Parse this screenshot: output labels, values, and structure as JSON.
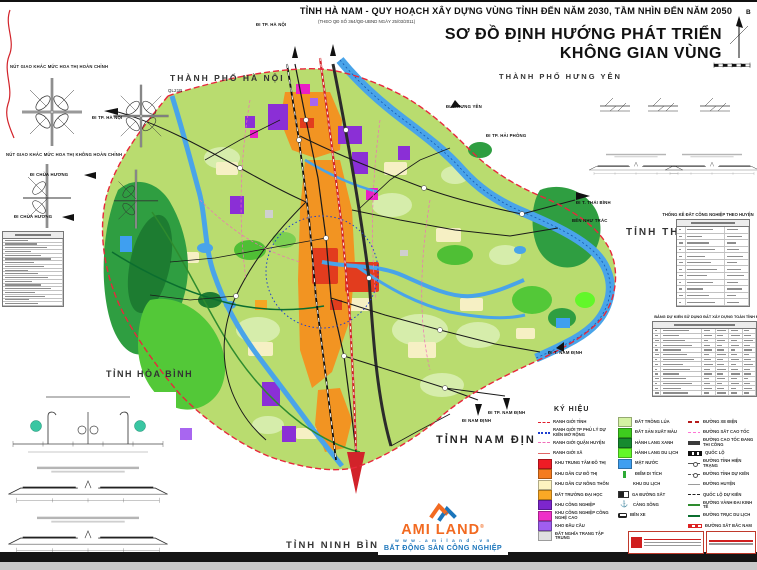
{
  "header": {
    "doc_title": "TỈNH HÀ NAM - QUY HOẠCH XÂY DỰNG VÙNG TỈNH ĐẾN NĂM 2030, TẦM NHÌN ĐẾN NĂM 2050",
    "doc_subtitle": "(THEO QĐ SỐ 364/QĐ-UBND NGÀY 25/03/2011)",
    "map_title_line1": "SƠ ĐỒ ĐỊNH HƯỚNG PHÁT TRIỂN",
    "map_title_line2": "KHÔNG GIAN VÙNG",
    "compass_label": "B"
  },
  "neighbors": {
    "ha_noi": "THÀNH PHỐ HÀ NỘI",
    "hung_yen": "THÀNH PHỐ HƯNG YÊN",
    "thai_binh": "TỈNH THÁI BÌNH",
    "hoa_binh": "TỈNH HÒA BÌNH",
    "nam_dinh": "TỈNH NAM ĐỊNH",
    "ninh_binh": "TỈNH NINH BÌNH"
  },
  "map_labels": {
    "di_tp_ha_noi_top": "ĐI TP. HÀ NỘI",
    "di_tp_ha_noi_left": "ĐI TP. HÀ NỘI",
    "ql21b": "QL21B",
    "di_t_hung_yen": "ĐI T. HƯNG YÊN",
    "di_tp_hai_phong": "ĐI TP. HẢI PHÒNG",
    "di_t_thai_binh": "ĐI T. THÁI BÌNH",
    "ben_nhu_trac": "BẾN NHƯ TRÁC",
    "di_t_nam_dinh": "ĐI T. NAM ĐỊNH",
    "di_nam_dinh": "ĐI NAM ĐỊNH",
    "di_tp_nam_dinh": "ĐI TP. NAM ĐỊNH",
    "di_chua_huong_1": "ĐI CHÙA HƯƠNG",
    "di_chua_huong_2": "ĐI CHÙA HƯƠNG"
  },
  "left_panel": {
    "interchange_title_full": "NÚT GIAO KHÁC MỨC HOA THỊ HOÀN CHỈNH",
    "interchange_title_partial": "NÚT GIAO KHÁC MỨC HOA THỊ KHÔNG HOÀN CHỈNH",
    "list_table": {
      "placeholder_rows": 18
    }
  },
  "right_panel": {
    "table_industry": {
      "title": "THỐNG KÊ ĐẤT CÔNG NGHIỆP THEO HUYỆN",
      "placeholder_rows": 12
    },
    "table_landuse": {
      "title": "BẢNG DỰ KIẾN SỬ DỤNG ĐẤT XÂY DỰNG TOÀN TỈNH ĐẾN NĂM 2030",
      "placeholder_rows": 14
    }
  },
  "legend": {
    "title": "KÝ HIỆU",
    "col1": [
      {
        "swatch": "line-red-dash",
        "label": "RANH GIỚI TỈNH"
      },
      {
        "swatch": "line-blue-dots",
        "label": "RANH GIỚI TP PHỦ LÝ DỰ KIẾN MỞ RỘNG"
      },
      {
        "swatch": "line-pink-dash",
        "label": "RANH GIỚI QUẬN HUYỆN"
      },
      {
        "swatch": "line-red-thin",
        "label": "RANH GIỚI XÃ"
      },
      {
        "color": "#ee1c25",
        "label": "KHU TRUNG TÂM ĐÔ THỊ"
      },
      {
        "color": "#f47b20",
        "label": "KHU DÂN CƯ ĐÔ THỊ"
      },
      {
        "color": "#fdf3c0",
        "label": "KHU DÂN CƯ NÔNG THÔN"
      },
      {
        "color": "#f9a825",
        "label": "ĐẤT TRƯỜNG ĐẠI HỌC"
      },
      {
        "color": "#7d26cd",
        "label": "KHU CÔNG NGHIỆP"
      },
      {
        "color": "#ee2fc8",
        "label": "KHU CÔNG NGHIỆP CÔNG NGHỆ CAO"
      },
      {
        "color": "#a05ef0",
        "label": "KHO ĐẦU CẦU"
      },
      {
        "color": "#e0e0e0",
        "label": "ĐẤT NGHĨA TRANG TẬP TRUNG"
      }
    ],
    "col2": [
      {
        "color": "#d4f2a2",
        "label": "ĐẤT TRỒNG LÚA"
      },
      {
        "color": "#3ecc1e",
        "label": "ĐẤT SẢN XUẤT MÀU"
      },
      {
        "color": "#168a2f",
        "label": "HÀNH LANG XANH"
      },
      {
        "color": "#62f72a",
        "label": "HÀNH LANG DU LỊCH"
      },
      {
        "color": "#3f9ff0",
        "label": "MẶT NƯỚC"
      },
      {
        "swatch": "tick-green",
        "label": "ĐIỂM DI TÍCH"
      },
      {
        "swatch": "none",
        "label": "KHU DU LỊCH"
      },
      {
        "swatch": "ic-sta",
        "label": "GA ĐƯỜNG SẮT"
      },
      {
        "swatch": "ic-anchor",
        "glyph": "⚓",
        "label": "CẢNG SÔNG"
      },
      {
        "swatch": "ic-bus",
        "label": "BẾN XE"
      }
    ],
    "col3": [
      {
        "swatch": "line-red-dash2",
        "label": "ĐƯỜNG XE ĐIỆN"
      },
      {
        "swatch": "line-pink-dash2",
        "label": "ĐƯỜNG SẮT CAO TỐC"
      },
      {
        "swatch": "line-dark-thick",
        "label": "ĐƯỜNG CAO TỐC ĐANG THI CÔNG"
      },
      {
        "swatch": "line-ql",
        "label": "QUỐC LỘ"
      },
      {
        "swatch": "line-circle",
        "label": "ĐƯỜNG TỈNH HIỆN TRẠNG"
      },
      {
        "swatch": "line-circle-dash",
        "label": "ĐƯỜNG TỈNH DỰ KIẾN"
      },
      {
        "swatch": "line-gray",
        "label": "ĐƯỜNG HUYỆN"
      },
      {
        "swatch": "line-black-dash",
        "label": "QUỐC LỘ DỰ KIẾN"
      },
      {
        "swatch": "line-green",
        "label": "ĐƯỜNG VÀNH ĐAI KINH TẾ"
      },
      {
        "swatch": "line-dgreen",
        "label": "ĐƯỜNG TRỤC DU LỊCH"
      },
      {
        "swatch": "line-rail-red",
        "label": "ĐƯỜNG SẮT BẮC NAM"
      }
    ]
  },
  "logo": {
    "brand": "AMI LAND",
    "reg": "®",
    "website": "w w w . a m i l a n d . v n",
    "tagline": "BẤT ĐỘNG SẢN CÔNG NGHIỆP"
  },
  "palette": {
    "boundary_red": "#e8283c",
    "water_blue": "#49a4e9",
    "land_green": "#b9dc6f",
    "urban_orange": "#f29422",
    "industry_purple": "#8b2fd6",
    "hitech_magenta": "#ea1fc6",
    "brand_orange": "#f26a21",
    "brand_blue": "#1b75bb"
  }
}
